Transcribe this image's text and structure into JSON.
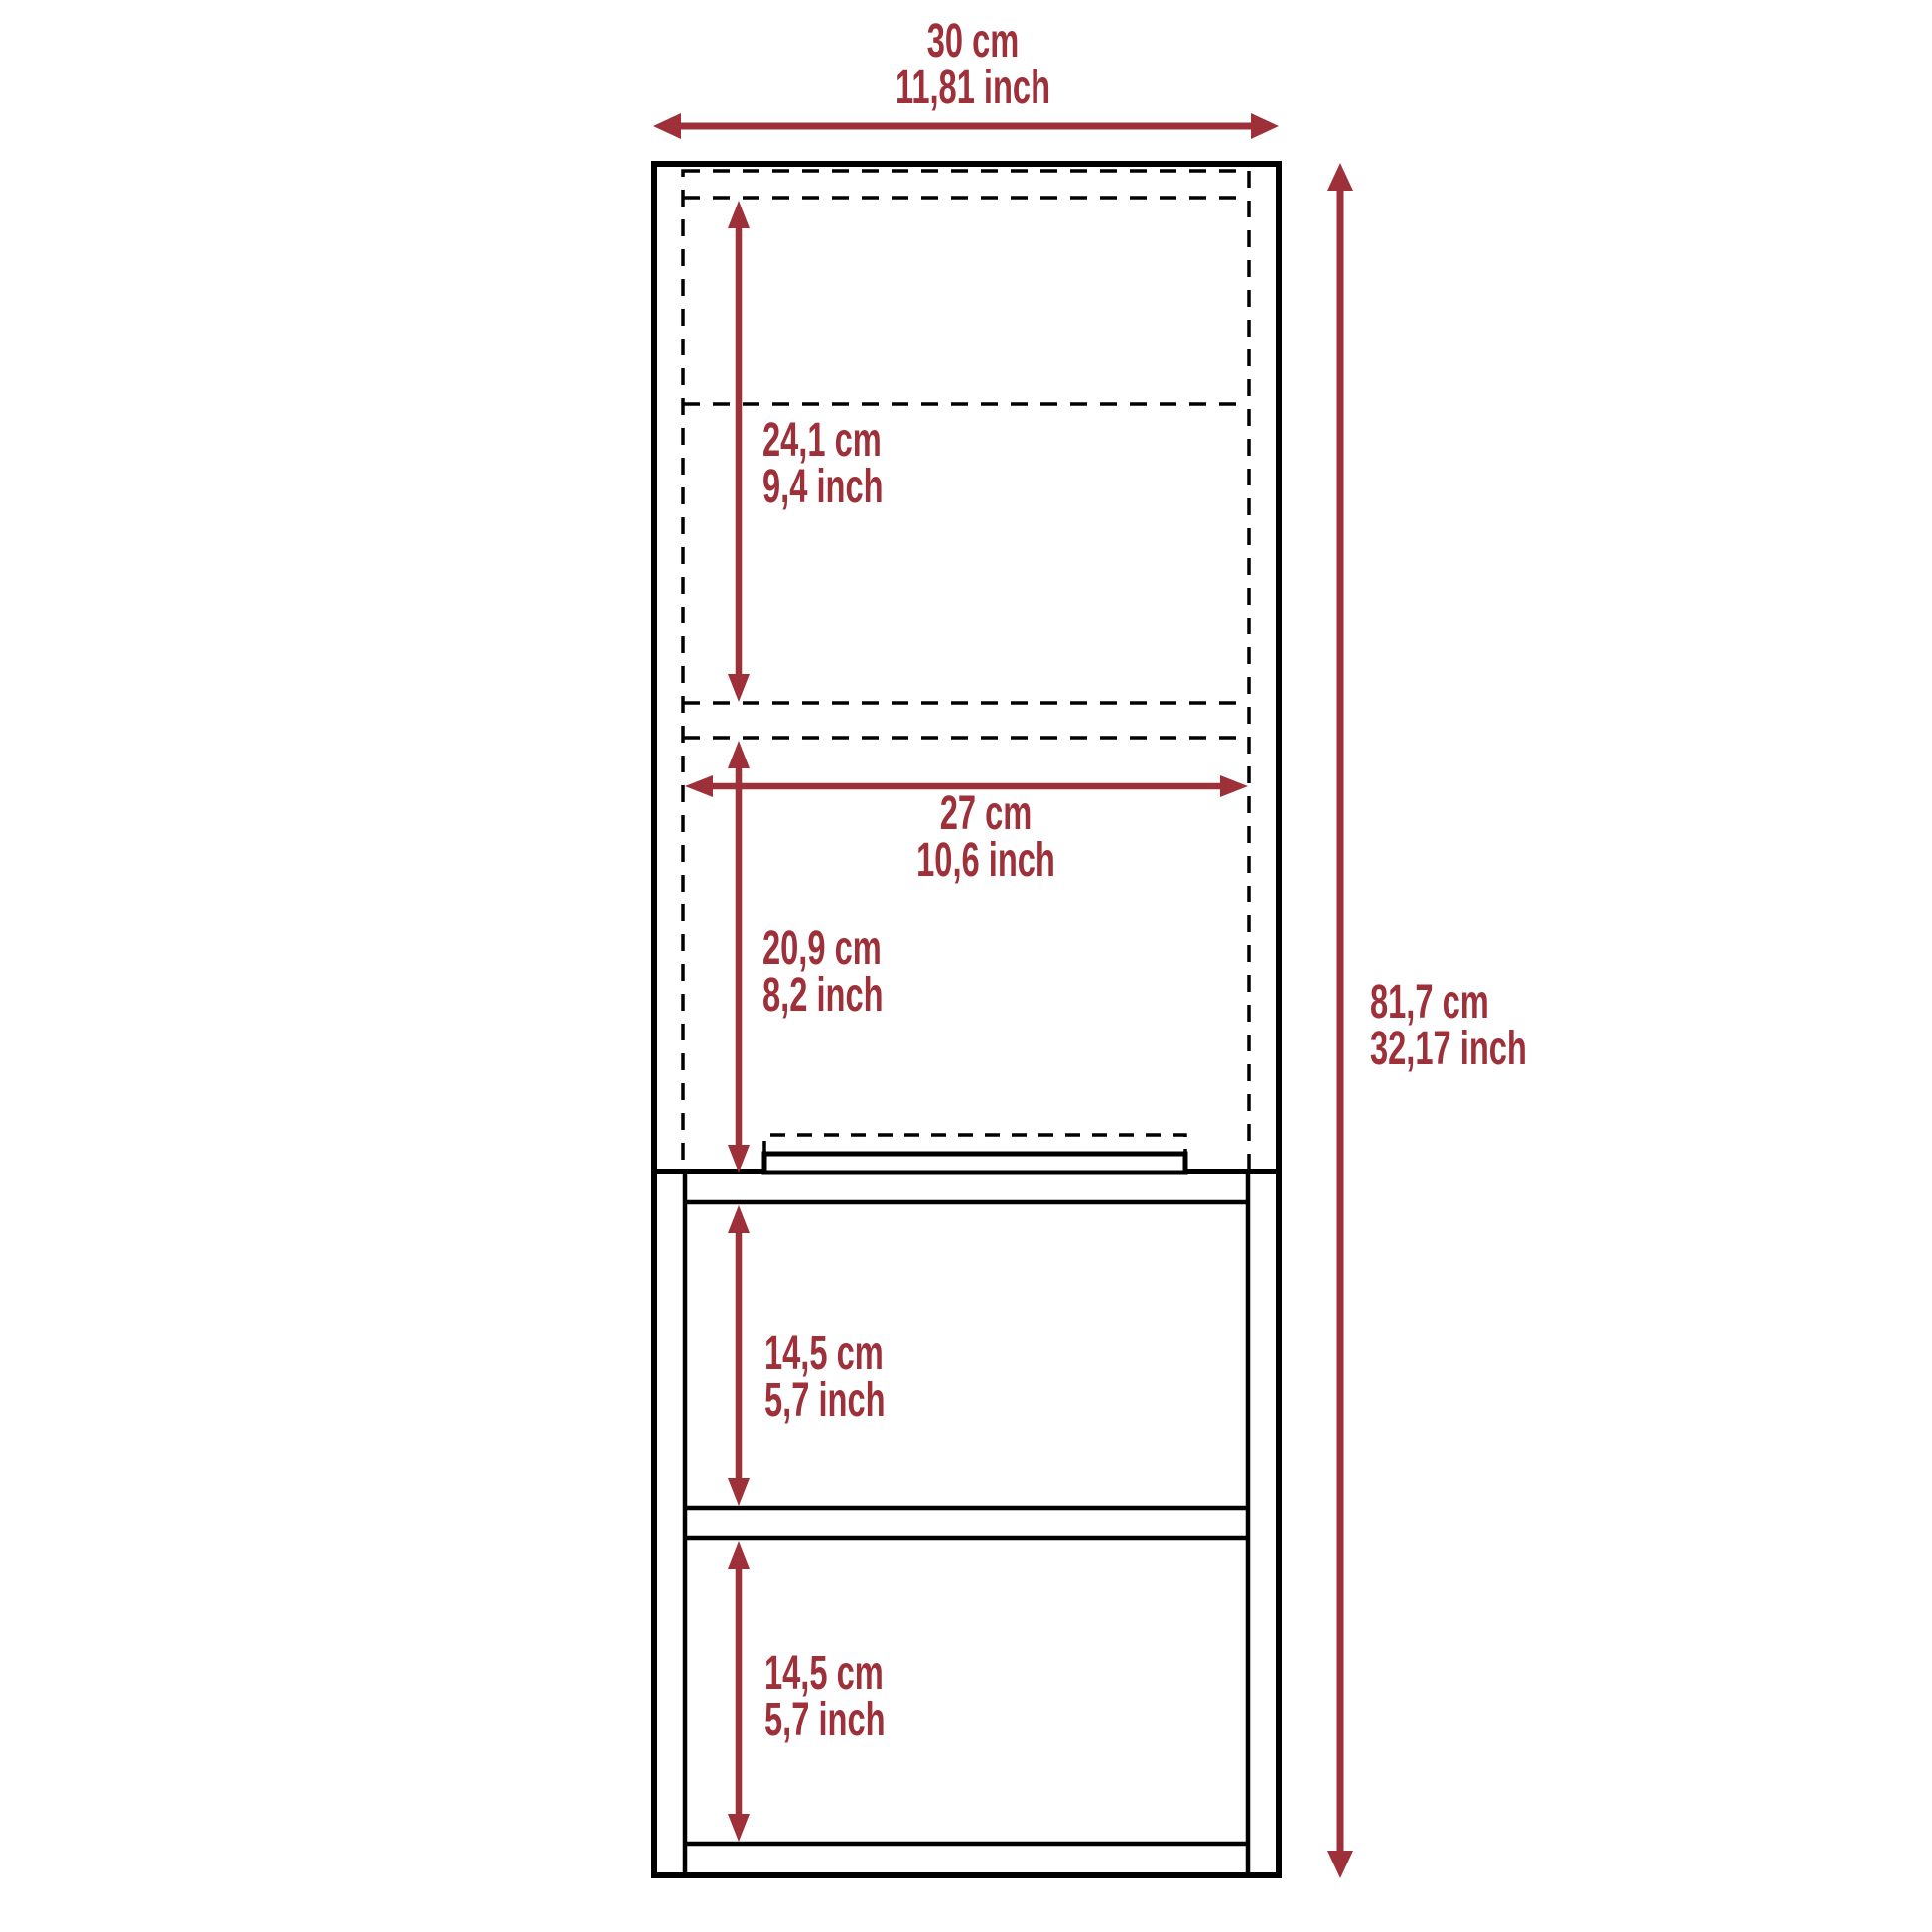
{
  "diagram": {
    "type": "furniture-dimension-drawing",
    "subject": "tall cabinet with upper door section and two open shelves",
    "colors": {
      "accent": "#9D3039",
      "line": "#000000",
      "background": "#FFFFFF"
    },
    "labels": {
      "overall_width": {
        "cm": "30 cm",
        "inch": "11,81 inch"
      },
      "overall_height": {
        "cm": "81,7 cm",
        "inch": "32,17 inch"
      },
      "upper_section_height": {
        "cm": "24,1 cm",
        "inch": "9,4 inch"
      },
      "inner_width": {
        "cm": "27 cm",
        "inch": "10,6 inch"
      },
      "door_section_height": {
        "cm": "20,9 cm",
        "inch": "8,2 inch"
      },
      "upper_shelf_height": {
        "cm": "14,5 cm",
        "inch": "5,7 inch"
      },
      "lower_shelf_height": {
        "cm": "14,5 cm",
        "inch": "5,7 inch"
      }
    }
  }
}
